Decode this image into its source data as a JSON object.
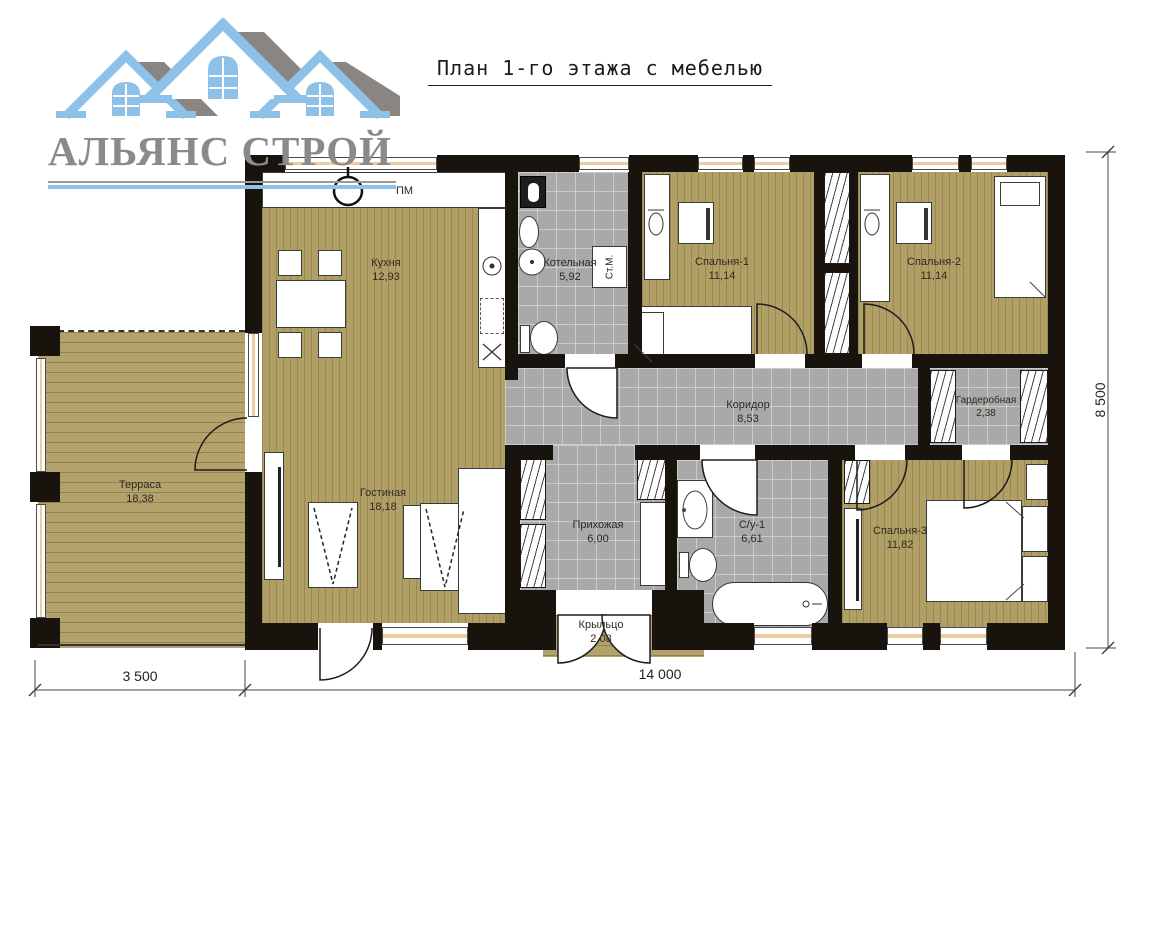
{
  "logo": {
    "company_name": "АЛЬЯНС СТРОЙ"
  },
  "title": "План 1-го этажа с мебелью",
  "rooms": [
    {
      "name": "Кухня",
      "area": "12,93"
    },
    {
      "name": "Котельная",
      "area": "5,92"
    },
    {
      "name": "Спальня-1",
      "area": "11,14"
    },
    {
      "name": "Спальня-2",
      "area": "11,14"
    },
    {
      "name": "Коридор",
      "area": "8,53"
    },
    {
      "name": "Гардеробная",
      "area": "2,38"
    },
    {
      "name": "Терраса",
      "area": "18,38"
    },
    {
      "name": "Гостиная",
      "area": "18,18"
    },
    {
      "name": "Прихожая",
      "area": "6,00"
    },
    {
      "name": "С/у-1",
      "area": "6,61"
    },
    {
      "name": "Спальня-3",
      "area": "11,82"
    },
    {
      "name": "Крыльцо",
      "area": "2,08"
    }
  ],
  "appliances": {
    "dishwasher": "ПМ",
    "washing_machine": "Ст.М."
  },
  "dimensions": {
    "terrace_width": "3 500",
    "house_width": "14 000",
    "house_depth": "8 500"
  },
  "colors": {
    "wall": "#19130e",
    "wood_floor": "#b1a066",
    "deck_floor": "#b3a26b",
    "tile_floor": "#a9a9a9",
    "window": "#eecb9f",
    "logo_blue": "#8ec1e8",
    "logo_roof_grey": "#8a8580",
    "logo_text_grey": "#8a8a88"
  }
}
